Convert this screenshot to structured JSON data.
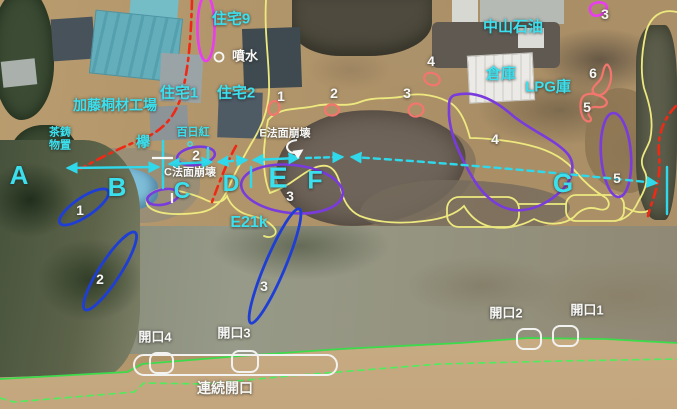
{
  "scene": {
    "type": "annotated-aerial-photo",
    "subject": "River levee breach damage survey map with slope failures, cracks and openings"
  },
  "colors": {
    "cyan_label": "#3be0ee",
    "white_label": "#f7f7f5",
    "survey_arrow": "#2fd8ea",
    "flood_outline_yellow": "#ede97f",
    "levee_red_dashed": "#ee2a17",
    "damage_zone_purple": "#7a3bdc",
    "crack_blue": "#1e3ed6",
    "magenta_zone": "#ea3cf0",
    "spot_salmon": "#f3766e",
    "boundary_green_solid": "#3ddb4b",
    "boundary_green_dashed": "#55e95d"
  },
  "annotations": {
    "labels": [
      {
        "name": "label-house-9",
        "text": "住宅9",
        "x": 231,
        "y": 19,
        "color": "cyan",
        "size": 15
      },
      {
        "name": "label-fountain",
        "text": "噴水",
        "x": 245,
        "y": 57,
        "color": "white",
        "size": 13
      },
      {
        "name": "label-house-1",
        "text": "住宅1",
        "x": 179,
        "y": 93,
        "color": "cyan",
        "size": 15
      },
      {
        "name": "label-house-2",
        "text": "住宅2",
        "x": 236,
        "y": 93,
        "color": "cyan",
        "size": 15
      },
      {
        "name": "label-kato-wood-factory",
        "text": "加藤桐材工場",
        "x": 115,
        "y": 105,
        "color": "cyan",
        "size": 14
      },
      {
        "name": "label-tea-shed",
        "text": "茶鋳\n物置",
        "x": 60,
        "y": 139,
        "color": "cyan",
        "size": 11
      },
      {
        "name": "label-zelkova-tree",
        "text": "欅",
        "x": 143,
        "y": 142,
        "color": "cyan",
        "size": 14
      },
      {
        "name": "label-crape-myrtle",
        "text": "百日紅",
        "x": 193,
        "y": 133,
        "color": "cyan",
        "size": 11
      },
      {
        "name": "label-nakayama-oil",
        "text": "中山石油",
        "x": 513,
        "y": 27,
        "color": "cyan",
        "size": 15
      },
      {
        "name": "label-warehouse",
        "text": "倉庫",
        "x": 501,
        "y": 74,
        "color": "cyan",
        "size": 15
      },
      {
        "name": "label-lpg-store",
        "text": "LPG庫",
        "x": 548,
        "y": 87,
        "color": "cyan",
        "size": 15
      },
      {
        "name": "label-e21k",
        "text": "E21k",
        "x": 249,
        "y": 223,
        "color": "cyan",
        "size": 16
      },
      {
        "name": "label-slope-failure-e",
        "text": "E法面崩壊",
        "x": 285,
        "y": 134,
        "color": "white",
        "size": 11
      },
      {
        "name": "label-slope-failure-c",
        "text": "C法面崩壊",
        "x": 190,
        "y": 173,
        "color": "white",
        "size": 11
      },
      {
        "name": "label-opening-1",
        "text": "開口1",
        "x": 587,
        "y": 311,
        "color": "white",
        "size": 13
      },
      {
        "name": "label-opening-2",
        "text": "開口2",
        "x": 506,
        "y": 314,
        "color": "white",
        "size": 13
      },
      {
        "name": "label-opening-3",
        "text": "開口3",
        "x": 234,
        "y": 334,
        "color": "white",
        "size": 13
      },
      {
        "name": "label-opening-4",
        "text": "開口4",
        "x": 155,
        "y": 338,
        "color": "white",
        "size": 13
      },
      {
        "name": "label-continuous-opening",
        "text": "連続開口",
        "x": 225,
        "y": 388,
        "color": "white",
        "size": 14
      }
    ],
    "section_letters": [
      {
        "text": "A",
        "x": 19,
        "y": 176,
        "size": 26
      },
      {
        "text": "B",
        "x": 117,
        "y": 188,
        "size": 26
      },
      {
        "text": "C",
        "x": 182,
        "y": 190,
        "size": 23
      },
      {
        "text": "D",
        "x": 231,
        "y": 183,
        "size": 23
      },
      {
        "text": "E",
        "x": 278,
        "y": 179,
        "size": 29
      },
      {
        "text": "F",
        "x": 315,
        "y": 181,
        "size": 25
      },
      {
        "text": "G",
        "x": 563,
        "y": 184,
        "size": 26
      }
    ],
    "numbers": [
      {
        "text": "1",
        "x": 281,
        "y": 96,
        "group": "red-spot"
      },
      {
        "text": "2",
        "x": 334,
        "y": 93,
        "group": "red-spot"
      },
      {
        "text": "3",
        "x": 407,
        "y": 93,
        "group": "red-spot"
      },
      {
        "text": "4",
        "x": 431,
        "y": 61,
        "group": "red-spot"
      },
      {
        "text": "2",
        "x": 196,
        "y": 155,
        "group": "purple-zone"
      },
      {
        "text": "3",
        "x": 290,
        "y": 196,
        "group": "purple-zone"
      },
      {
        "text": "4",
        "x": 495,
        "y": 139,
        "group": "purple-zone"
      },
      {
        "text": "5",
        "x": 617,
        "y": 178,
        "group": "purple-zone"
      },
      {
        "text": "1",
        "x": 80,
        "y": 210,
        "group": "blue-crack"
      },
      {
        "text": "2",
        "x": 100,
        "y": 279,
        "group": "blue-crack"
      },
      {
        "text": "3",
        "x": 264,
        "y": 286,
        "group": "blue-crack"
      },
      {
        "text": "5",
        "x": 587,
        "y": 107,
        "group": "salmon-mark"
      },
      {
        "text": "6",
        "x": 593,
        "y": 73,
        "group": "salmon-mark"
      },
      {
        "text": "3",
        "x": 605,
        "y": 14,
        "group": "magenta-zone"
      }
    ]
  }
}
